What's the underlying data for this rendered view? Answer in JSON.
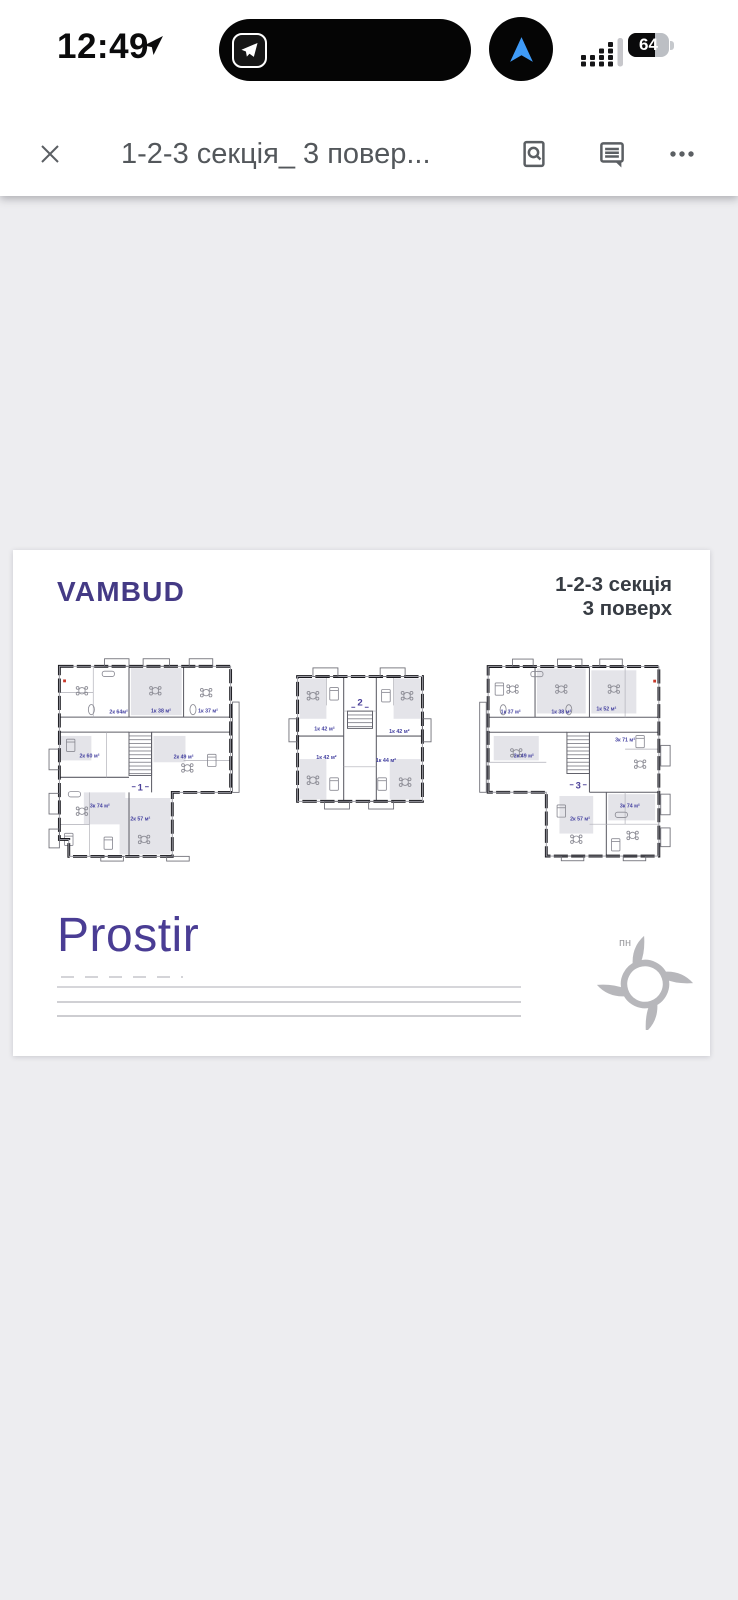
{
  "status_bar": {
    "time": "12:49",
    "battery_percent": "64"
  },
  "viewer_toolbar": {
    "document_title": "1-2-3 секція_ 3 повер..."
  },
  "document": {
    "brand": "VAMBUD",
    "heading": {
      "line1": "1-2-3 секція",
      "line2": "3 поверх"
    },
    "project_logo": "Prostir",
    "compass_north_label": "пн",
    "sections": [
      {
        "number": "1",
        "apartments": [
          {
            "label": "2к 64м²"
          },
          {
            "label": "1к 38 м²"
          },
          {
            "label": "1к 37 м²"
          },
          {
            "label": "2к 60 м²"
          },
          {
            "label": "2к 49 м²"
          },
          {
            "label": "3к 74 м²"
          },
          {
            "label": "2к 57 м²"
          }
        ]
      },
      {
        "number": "2",
        "apartments": [
          {
            "label": "1к 42 м²"
          },
          {
            "label": "1к 42 м²"
          },
          {
            "label": "1к 42 м²"
          },
          {
            "label": "1к 44 м²"
          }
        ]
      },
      {
        "number": "3",
        "apartments": [
          {
            "label": "1к 37 м²"
          },
          {
            "label": "1к 38 м²"
          },
          {
            "label": "1к 52 м²"
          },
          {
            "label": "2к 49 м²"
          },
          {
            "label": "3к 71 м²"
          },
          {
            "label": "2к 57 м²"
          },
          {
            "label": "3к 74 м²"
          }
        ]
      }
    ]
  },
  "colors": {
    "brand_purple": "#443a85",
    "label_purple": "#4441a0",
    "logo_purple": "#4a3d94",
    "app_background": "#ededf0",
    "page_background": "#ffffff",
    "nav_arrow_blue": "#3f9bf8",
    "toolbar_icon_gray": "#5b5f63"
  }
}
